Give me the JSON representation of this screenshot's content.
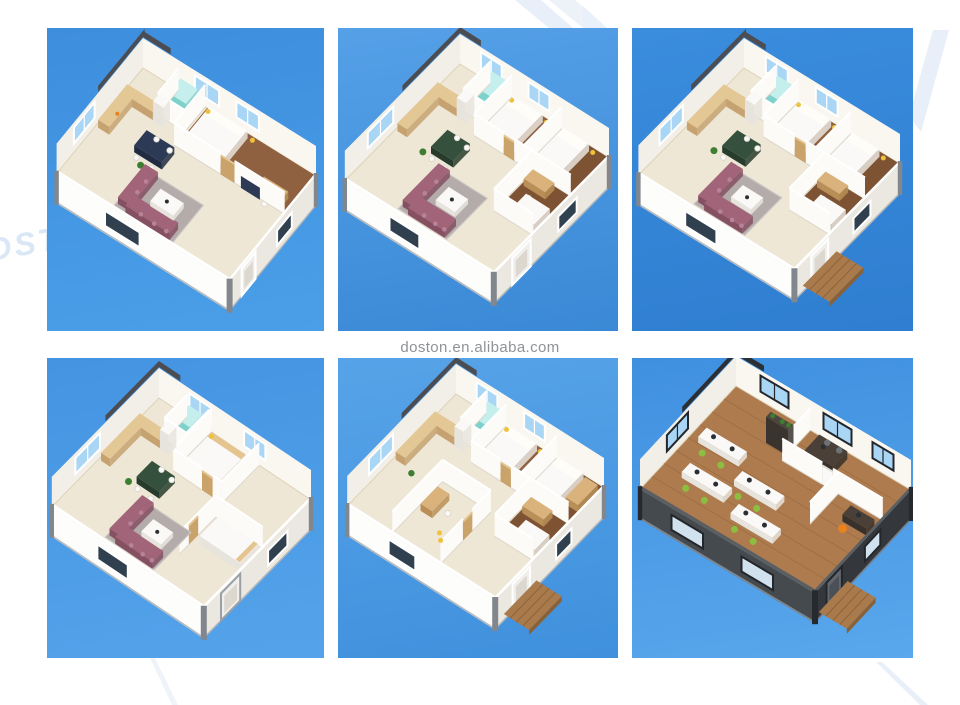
{
  "page": {
    "background": "#ffffff"
  },
  "watermark": {
    "text": "doston.en.alibaba.com",
    "color": "#8f9396"
  },
  "logo": {
    "letters": "DST",
    "letters_color": "#d9e7f6",
    "shape_color": "#e8eff8"
  },
  "palette": {
    "cream": "#efe7d6",
    "creamEdge": "#ddd1b6",
    "wood": "#8f6140",
    "wood2": "#7d5333",
    "woodOffice": "#ad7b4e",
    "woodOfficeDark": "#8f6137",
    "bwL": "#f2efe8",
    "bwR": "#faf7f1",
    "fwL": "#fdfdfb",
    "fwR": "#ebe8e1",
    "rim": "#ffffff",
    "officeFwL": "#454a4f",
    "officeFwR": "#34383c",
    "officeRim": "#5a5f64",
    "wallFace": "#fcfbf8",
    "wallTopLine": "#ffffff",
    "wallShade": "#ddd7ca",
    "beam": "#4b4d52",
    "beamDark": "#2c2f33",
    "glass": "#a9d6f4",
    "frame": "#ffffff",
    "glassDark": "#31404e",
    "frameDark": "#23262a",
    "glassOffice": "#cfe2ee",
    "teal": "#7fd2cc",
    "tealTop": "#c5efec",
    "counter": "#c6a271",
    "counterTop": "#e3c795",
    "navy": "#2c3a55",
    "navyDark": "#1f2c42",
    "green": "#35503c",
    "greenDark": "#273c2c",
    "rug": "#b3acab",
    "rugEdge": "#cbc5c3",
    "mauve": "#a26478",
    "mauveDark": "#855061",
    "mauveLight": "#b8839a",
    "white": "#faf9f7",
    "whiteSide": "#e7e4dd",
    "pillow": "#fffdf8",
    "plant": "#3f7d33",
    "yellow": "#f0c23c",
    "tan": "#c9a36a",
    "tanTop": "#e4c58f",
    "deskTop": "#d9b27c",
    "deskSide": "#b98f57",
    "deck": "#a87a4c",
    "deckDark": "#8a6136",
    "deckLine": "#8f6238",
    "shelf": "#4e463e",
    "shelfDark": "#3a342e",
    "tableDark": "#4a4038",
    "tableDarker": "#38302a",
    "chairGreen": "#8cbf3f",
    "chairGray": "#6d7276",
    "monitor": "#2b2f33",
    "orange": "#e8821e",
    "post": "#82878d",
    "postDark": "#26292d",
    "base": "#9aa0a6"
  },
  "panels": [
    {
      "variant": "h1",
      "sky": [
        "#3d8edd",
        "#4b9fe8"
      ],
      "label": "Isometric 3D floor plan - expandable container house with bedroom, bathroom, kitchen, dining area and living room"
    },
    {
      "variant": "h2",
      "sky": [
        "#55a0e7",
        "#3a89d6"
      ],
      "label": "Isometric 3D floor plan - three-bedroom expandable container house with living room and kitchen"
    },
    {
      "variant": "h3",
      "sky": [
        "#3a8cdd",
        "#2f7ed1"
      ],
      "label": "Isometric 3D floor plan - three-bedroom expandable container house with entry deck"
    },
    {
      "variant": "h4",
      "sky": [
        "#4494e2",
        "#54a3ea"
      ],
      "label": "Isometric 3D floor plan - two-bedroom expandable container house with open lounge"
    },
    {
      "variant": "h5",
      "sky": [
        "#57a3e8",
        "#3f90dd"
      ],
      "label": "Isometric 3D floor plan - three-bedroom expandable container house with study and entry deck"
    },
    {
      "variant": "office",
      "sky": [
        "#3f90e0",
        "#59a7ec"
      ],
      "label": "Isometric 3D floor plan - open-plan container office with workstations, meeting room and private office"
    }
  ]
}
